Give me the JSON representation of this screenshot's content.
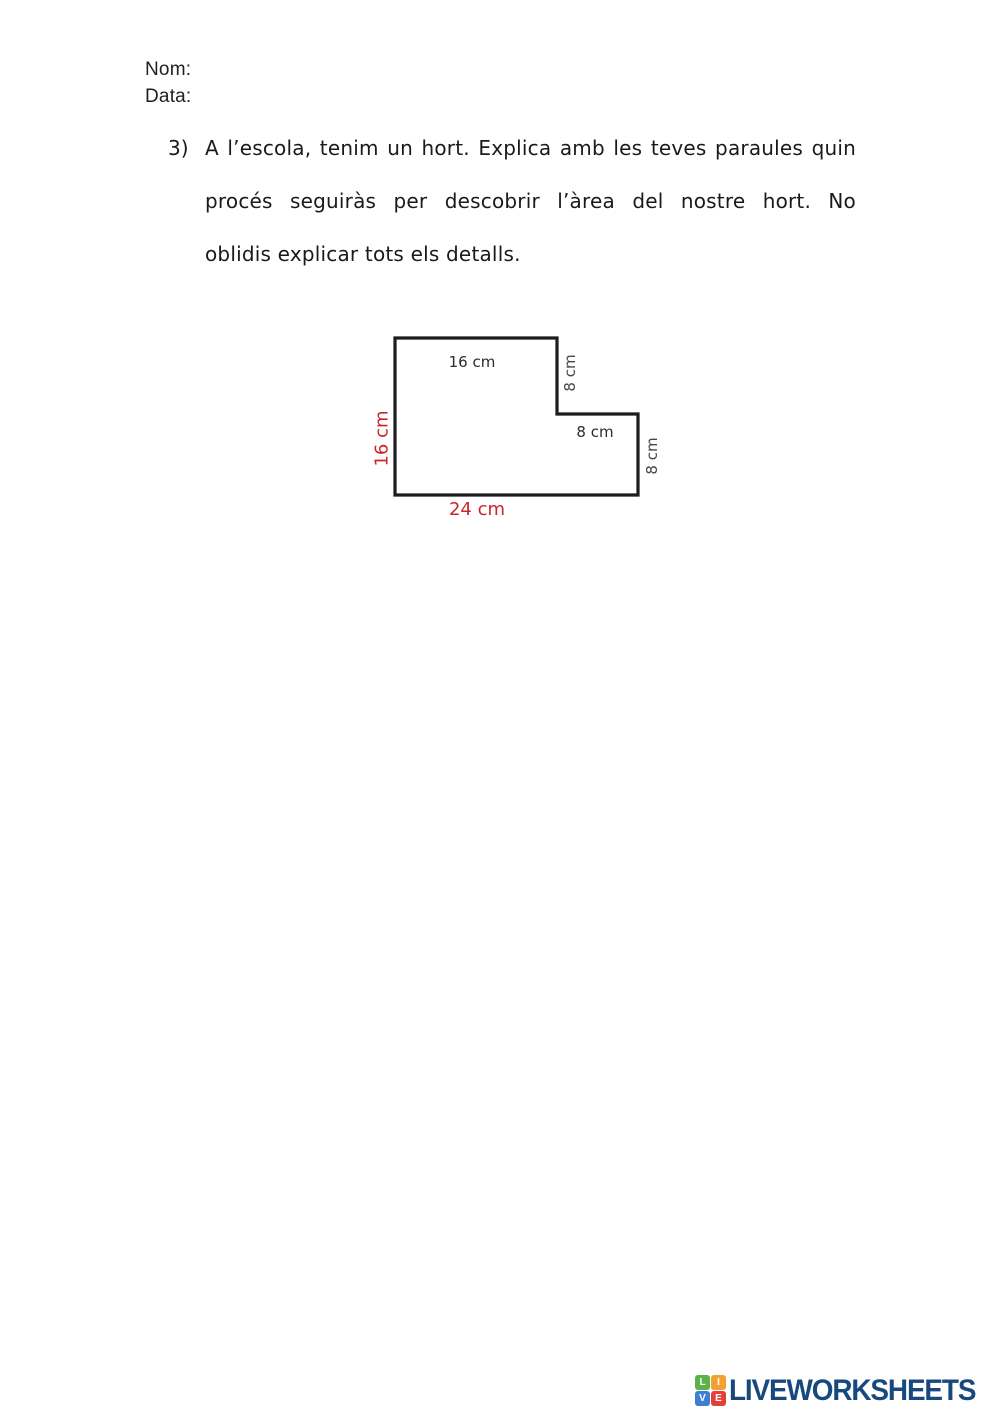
{
  "header": {
    "nom_label": "Nom:",
    "data_label": "Data:"
  },
  "question": {
    "number": "3)",
    "lines": [
      "A l’escola, tenim un hort. Explica amb les teves paraules quin",
      "procés seguiràs per descobrir l’àrea del nostre hort. No",
      "oblidis explicar tots els detalls."
    ]
  },
  "figure": {
    "shape": "L-shaped polygon (24 cm × 16 cm rectangle with 8 cm × 8 cm notch cut from top-right)",
    "outline_color": "#1c1c1c",
    "labels": {
      "top_width": "16 cm",
      "notch_height": "8 cm",
      "notch_width": "8 cm",
      "right_height": "8 cm",
      "left_height": "16 cm",
      "bottom_width": "24 cm"
    },
    "accent_red": "#cc2429",
    "dim_gray": "#474747"
  },
  "footer": {
    "logo": {
      "grid_letters": [
        "L",
        "I",
        "V",
        "E"
      ],
      "grid_colors": [
        "#5cb246",
        "#f0a132",
        "#3e7fd4",
        "#e3403a"
      ],
      "text": "LIVEWORKSHEETS",
      "text_color": "#17497f"
    }
  }
}
